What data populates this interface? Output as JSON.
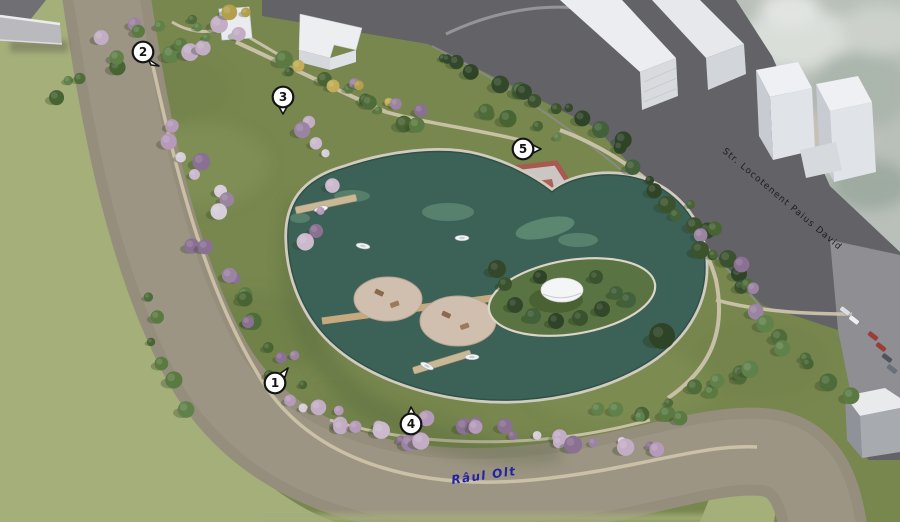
{
  "scene": {
    "type": "aerial-park-masterplan-render",
    "description": "3D aerial rendering of a riverside park with a heart-shaped lake, island pavilion, floating platforms, boardwalk, playground court and numbered points of interest",
    "boats": 5,
    "floating_platforms": 2,
    "parked_cars": 6
  },
  "labels": {
    "street": {
      "text": "Str. Locotenent Paius David",
      "color": "#1e1e20"
    },
    "river": {
      "text": "Râul Olt",
      "color": "#2222a8"
    }
  },
  "markers": {
    "style": {
      "fill": "#ffffff",
      "stroke": "#141414",
      "text_color": "#141414"
    },
    "items": [
      {
        "label": "1",
        "x": 275,
        "y": 383,
        "tail": "ne"
      },
      {
        "label": "2",
        "x": 143,
        "y": 52,
        "tail": "se"
      },
      {
        "label": "3",
        "x": 283,
        "y": 97,
        "tail": "s"
      },
      {
        "label": "4",
        "x": 411,
        "y": 424,
        "tail": "n"
      },
      {
        "label": "5",
        "x": 523,
        "y": 149,
        "tail": "e"
      }
    ]
  },
  "colors": {
    "park_green": "#77874e",
    "far_bank": "#a5af7a",
    "river": "#968e7c",
    "street": "#636367",
    "lake": "#3c6257",
    "walkway": "#d2ccc0",
    "boardwalk": "#c6aa7f",
    "island": "#5a7342",
    "court_border": "#a85a50",
    "building_roof": "#eceef0"
  }
}
